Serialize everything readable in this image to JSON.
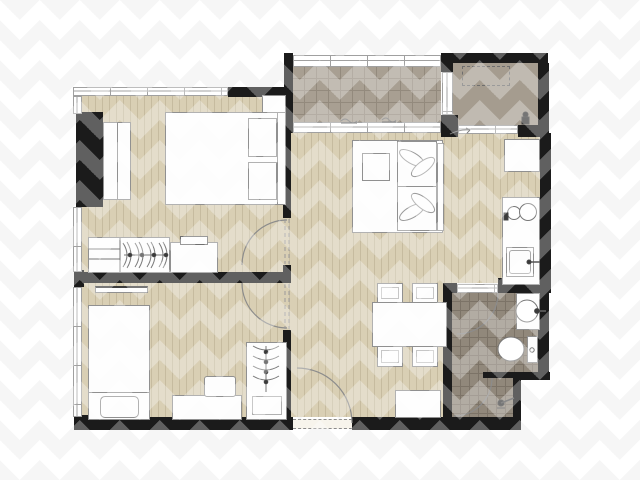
{
  "plan": {
    "kind": "apartment-floor-plan",
    "rooms": [
      {
        "name": "bedroom-1",
        "floor": "wood-plank",
        "furniture": [
          "double-bed",
          "two-pillows",
          "nightstand",
          "built-in-wardrobe",
          "dresser-with-hangers",
          "desk",
          "monitor"
        ]
      },
      {
        "name": "bedroom-2",
        "floor": "wood-plank",
        "furniture": [
          "single-bed",
          "pillow",
          "wall-shelf",
          "desk",
          "chair",
          "wardrobe-with-hangers"
        ]
      },
      {
        "name": "living-dining",
        "floor": "wood-plank",
        "furniture": [
          "double-bed-with-leaf-pillows",
          "dining-table",
          "four-chairs",
          "shoe-cabinet"
        ]
      },
      {
        "name": "kitchen-strip",
        "floor": "wood-plank",
        "fixtures": [
          "tall-cabinet",
          "two-burner-stove",
          "kitchen-sink"
        ]
      },
      {
        "name": "bathroom",
        "floor": "tile-grid",
        "fixtures": [
          "wash-basin",
          "toilet",
          "shower-head"
        ]
      },
      {
        "name": "balcony",
        "floor": "tile-grid",
        "fixtures": [
          "slippers",
          "slippers"
        ]
      },
      {
        "name": "ac-ledge",
        "floor": "plain",
        "fixtures": [
          "ac-unit-dashed-outline",
          "valve"
        ]
      }
    ],
    "doors": [
      "bedroom-1-swing-door",
      "bedroom-2-swing-door",
      "entrance-swing-door",
      "bathroom-swing-door",
      "shower-swing-door",
      "balcony-sliding-door",
      "ac-ledge-door"
    ],
    "windows": [
      "bedroom-1-top-window",
      "bedroom-1-left-window",
      "bedroom-2-left-window",
      "balcony-railing",
      "balcony-ac-window"
    ]
  },
  "colors": {
    "wall": "#1b1b1b",
    "wood": "#d9cfb4",
    "wood_line": "#c6bb9f",
    "balcony_tile": "#a89f92",
    "balcony_tile_line": "#938a7d",
    "bath_tile": "#91887b",
    "bath_tile_line": "#7c7367",
    "ac_floor": "#a59c8f",
    "furniture": "#fdfdfd",
    "furniture_line": "#909090",
    "window_line": "#a0a0a0",
    "arc_line": "#8c8c8c"
  }
}
